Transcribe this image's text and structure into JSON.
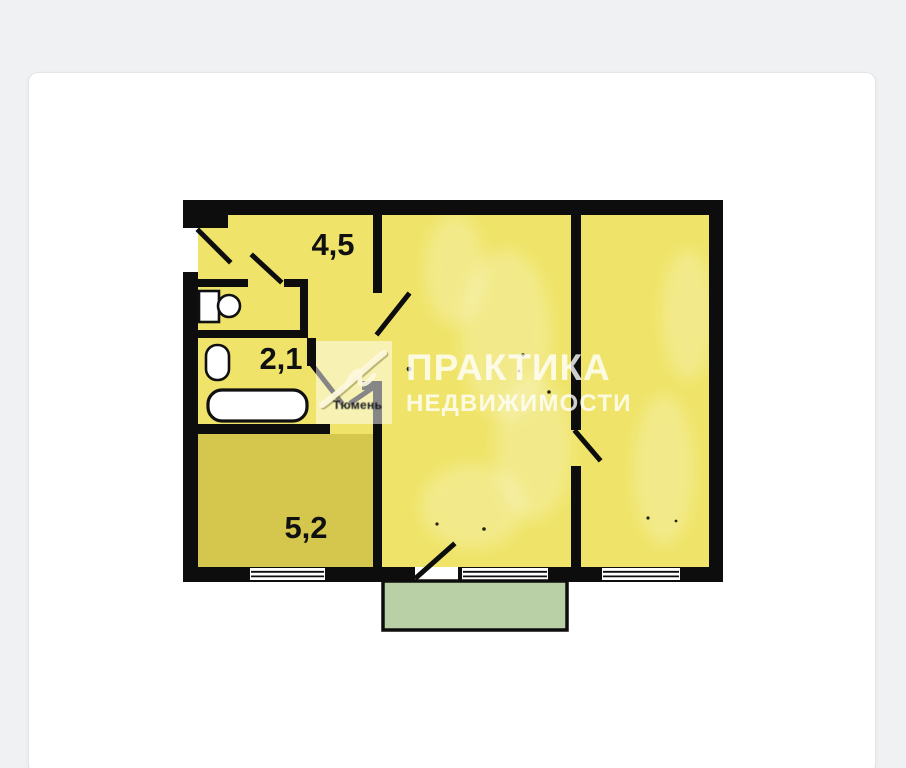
{
  "card": {
    "type": "floor-plan-image"
  },
  "floorplan": {
    "room_labels": [
      {
        "room": "hallway",
        "label": "4,5"
      },
      {
        "room": "bathroom",
        "label": "2,1"
      },
      {
        "room": "kitchen",
        "label": "5,2"
      }
    ],
    "fixtures": [
      "toilet-icon",
      "sink-icon",
      "bathtub-icon"
    ],
    "watermark": {
      "title": "ПРАКТИКА",
      "subtitle": "НЕДВИЖИМОСТИ",
      "logo_caption": "Тюмень"
    },
    "colors": {
      "room_fill": "#efe469",
      "kitchen_fill": "#d5c64d",
      "balcony_fill": "#b9cfa5",
      "wall": "#0d0d0d",
      "fixture_fill": "#ffffff",
      "card_background": "#ffffff",
      "page_background": "#f0f1f2"
    }
  }
}
